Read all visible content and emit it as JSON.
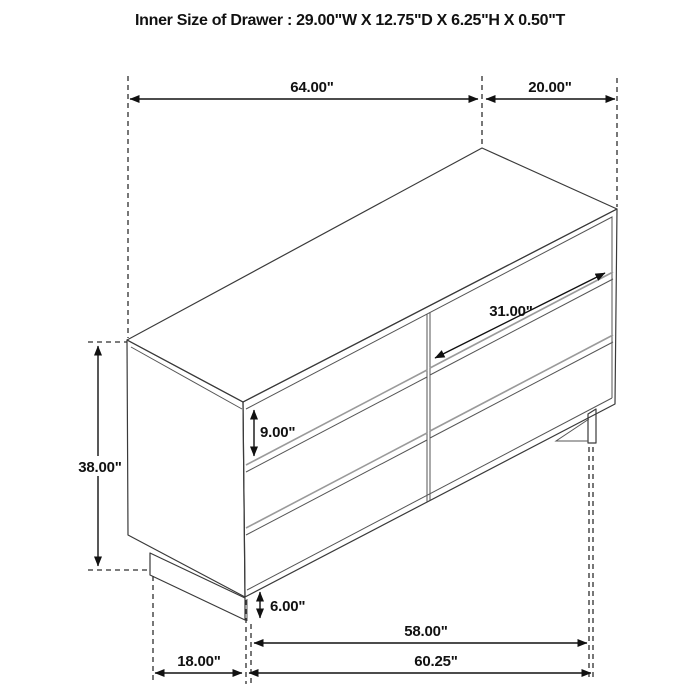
{
  "title": "Inner Size of Drawer : 29.00\"W X 12.75\"D X 6.25\"H X 0.50\"T",
  "figure": {
    "type": "furniture-dimension-diagram",
    "subject": "six-drawer-dresser",
    "background": "#ffffff",
    "outline_color": "#3a3a3a",
    "dimension_color": "#111111"
  },
  "dimensions": {
    "top_width": "64.00\"",
    "top_depth": "20.00\"",
    "drawer_width": "31.00\"",
    "drawer_height": "9.00\"",
    "overall_height": "38.00\"",
    "base_height": "6.00\"",
    "base_width": "58.00\"",
    "bottom_width": "60.25\"",
    "bottom_depth": "18.00\""
  }
}
